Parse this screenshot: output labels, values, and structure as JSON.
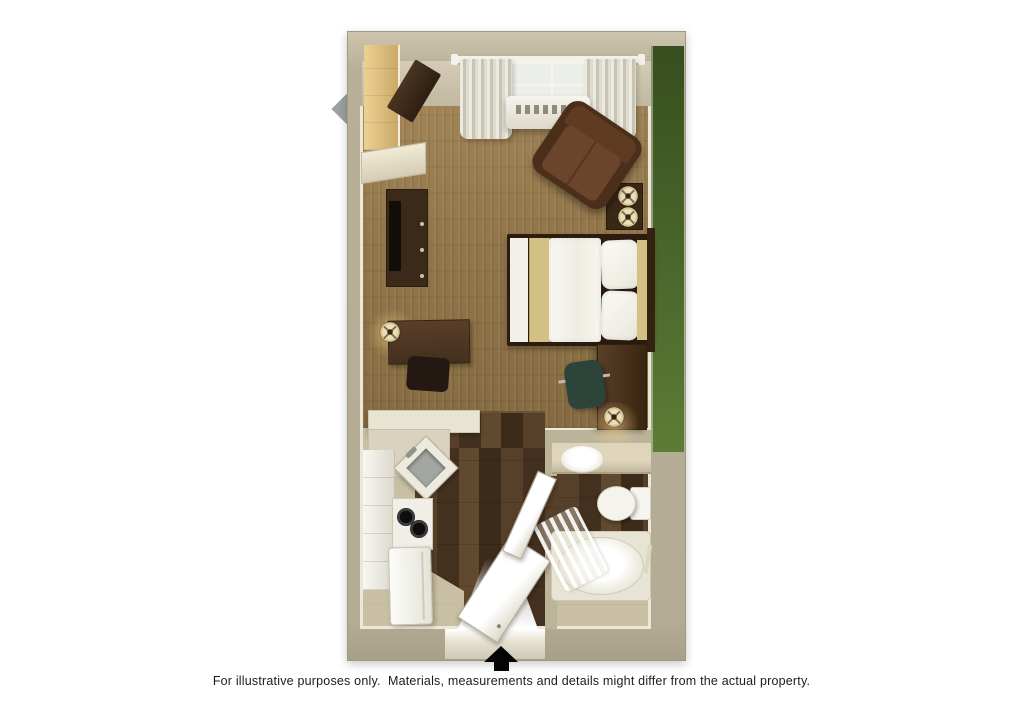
{
  "caption": "For illustrative purposes only.  Materials, measurements and details might differ from the actual property.",
  "plan": {
    "type": "3d-floorplan-top-view",
    "unit": "studio-suite",
    "rooms": [
      "bedroom-living-area",
      "kitchen",
      "bathroom",
      "entry-hall"
    ],
    "furniture": [
      "window-with-curtains",
      "ptac-air-conditioner",
      "closet",
      "wall-corner-cabinet",
      "tv-stand-with-tv",
      "writing-desk-with-lamp",
      "desk-chair",
      "queen-bed",
      "nightstand-with-two-lamps",
      "recliner-armchair",
      "work-desk",
      "office-chair",
      "table-lamp",
      "kitchen-counter-peninsula",
      "corner-sink",
      "two-burner-stove",
      "refrigerator",
      "kitchen-cabinets",
      "entry-door-open",
      "bathroom-door-open",
      "vanity-with-sink",
      "toilet",
      "bathtub-with-shower-curtain",
      "towel-bar"
    ],
    "entry_arrow_direction": "up"
  },
  "palette": {
    "wall": "#bcb39b",
    "wall_face": "#d4ccb6",
    "baseboard": "#ece7d8",
    "green_dark": "#374f1e",
    "green_mid": "#4a682c",
    "green_light": "#5d7c35",
    "carpet": "#93774b",
    "carpet_light": "#a28557",
    "wood": "#4a3522",
    "vinyl": "#c8bfa4",
    "mid_wood": "#5b3f28",
    "leather": "#4c2f1a",
    "leather_light": "#6a452b",
    "khaki": "#d2c084",
    "linen_white": "#f6f5ef",
    "teal": "#2c443a",
    "lamp_cream": "#ebdfba",
    "arrow_black": "#050505",
    "caption_color": "#1c1c1c"
  }
}
